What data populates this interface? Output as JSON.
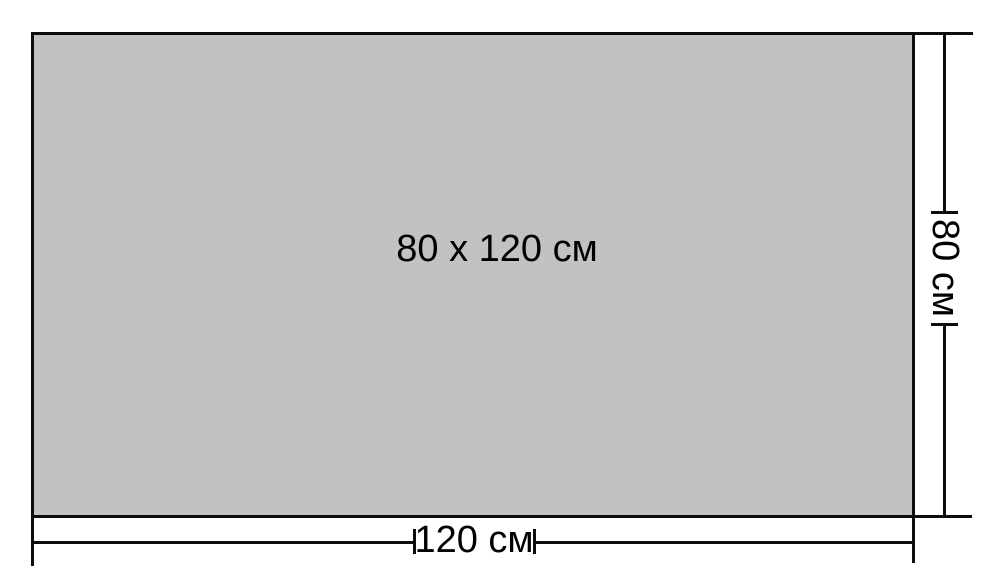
{
  "diagram": {
    "size_label": "80 x 120 см",
    "width_dimension_label": "120 см",
    "height_dimension_label": "80 см"
  },
  "colors": {
    "background": "#ffffff",
    "rect_fill": "#c2c2c2",
    "line": "#0d0d0d",
    "text": "#000000"
  }
}
